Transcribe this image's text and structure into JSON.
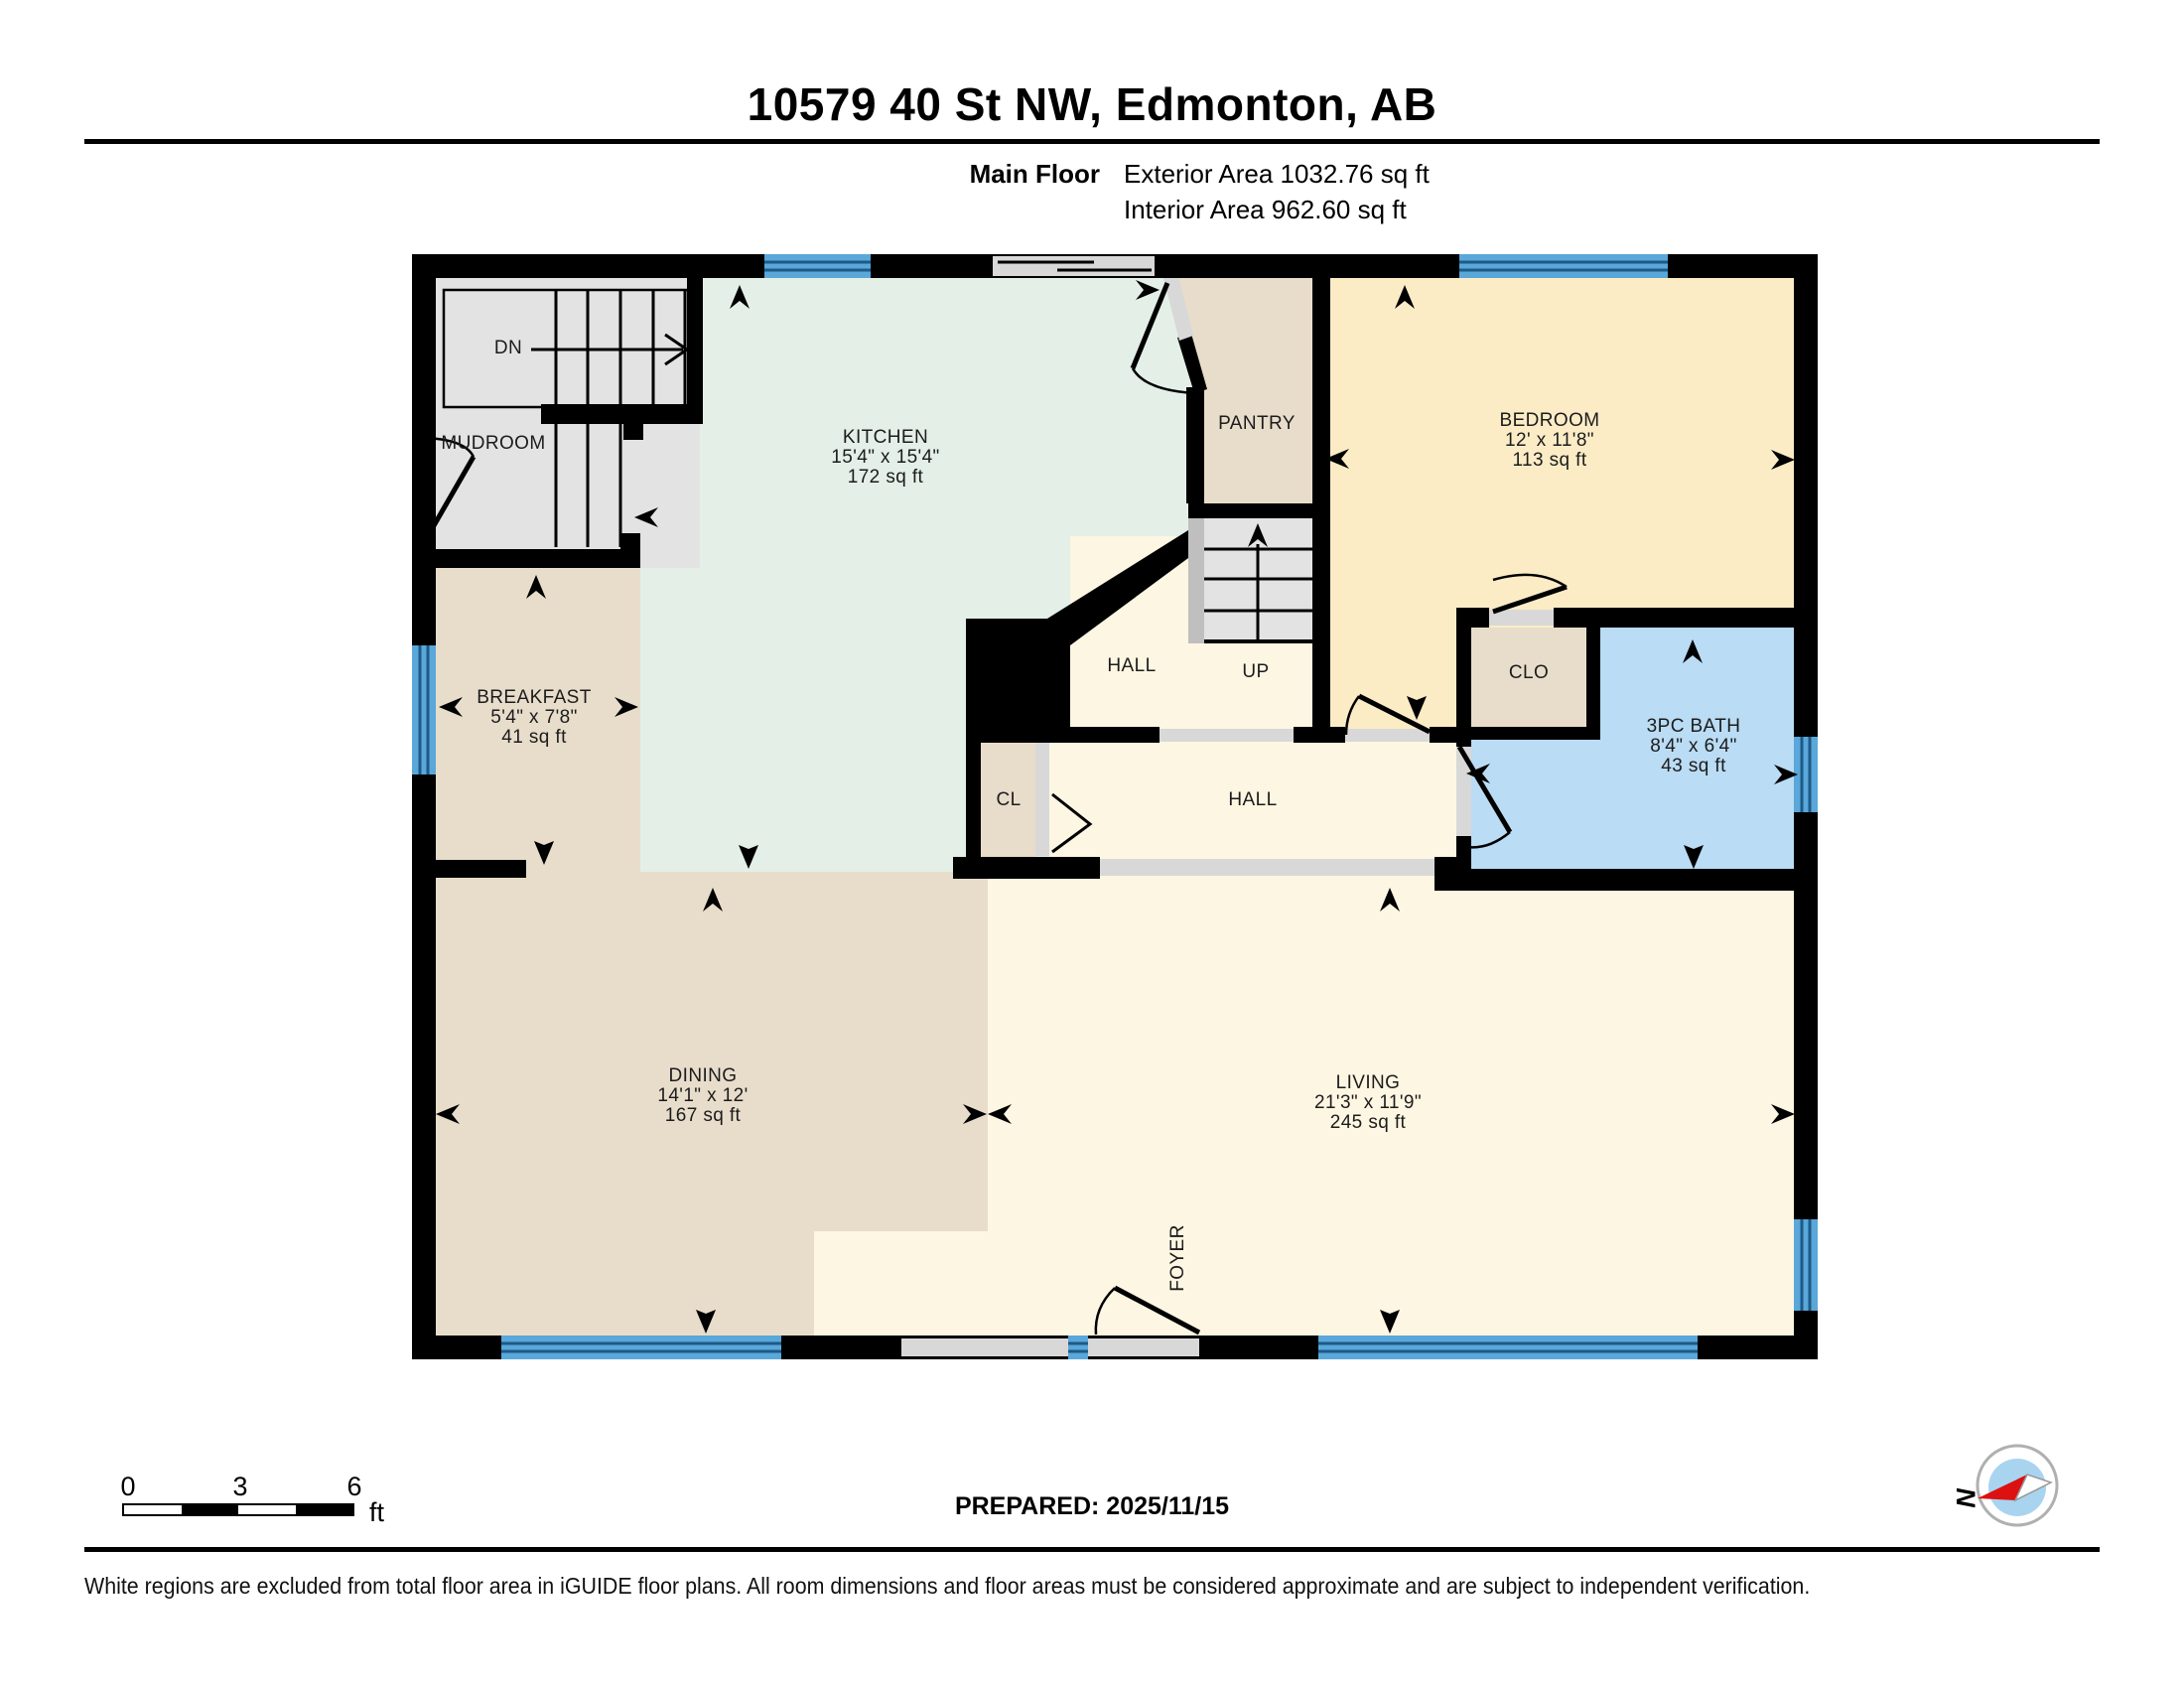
{
  "header": {
    "title": "10579 40 St NW, Edmonton, AB",
    "floor_label": "Main Floor",
    "exterior_area": "Exterior Area 1032.76 sq ft",
    "interior_area": "Interior Area 962.60 sq ft"
  },
  "rooms": {
    "mudroom": {
      "name": "MUDROOM"
    },
    "kitchen": {
      "name": "KITCHEN",
      "dims": "15'4\" x 15'4\"",
      "area": "172 sq ft"
    },
    "pantry": {
      "name": "PANTRY"
    },
    "bedroom": {
      "name": "BEDROOM",
      "dims": "12' x 11'8\"",
      "area": "113 sq ft"
    },
    "breakfast": {
      "name": "BREAKFAST",
      "dims": "5'4\" x 7'8\"",
      "area": "41 sq ft"
    },
    "hall_upper": {
      "name": "HALL"
    },
    "hall_lower": {
      "name": "HALL"
    },
    "stairs_up": {
      "name": "UP"
    },
    "stairs_dn": {
      "name": "DN"
    },
    "closet": {
      "name": "CLO"
    },
    "cl": {
      "name": "CL"
    },
    "bath": {
      "name": "3PC BATH",
      "dims": "8'4\" x 6'4\"",
      "area": "43 sq ft"
    },
    "dining": {
      "name": "DINING",
      "dims": "14'1\" x 12'",
      "area": "167 sq ft"
    },
    "living": {
      "name": "LIVING",
      "dims": "21'3\" x 11'9\"",
      "area": "245 sq ft"
    },
    "foyer": {
      "name": "FOYER"
    }
  },
  "footer": {
    "scale": {
      "t0": "0",
      "t3": "3",
      "t6": "6",
      "unit": "ft"
    },
    "prepared": "PREPARED: 2025/11/15",
    "compass_n": "N",
    "disclaimer": "White regions are excluded from total floor area in iGUIDE floor plans. All room dimensions and floor areas must be considered approximate and are subject to independent verification."
  },
  "colors": {
    "kitchen": "#e4efe8",
    "tan": "#e8ddcb",
    "cream": "#fdf6e2",
    "bedroom": "#fcecc6",
    "bath": "#badcf4",
    "gray": "#e3e3e3",
    "strip": "#bfbfbf",
    "threshold": "#d8d8d8",
    "window": "#5aa7d9",
    "window_line": "#1d5a87",
    "wall": "#000000",
    "compass_inner": "#a8d4f0",
    "compass_needle": "#dd1111"
  }
}
